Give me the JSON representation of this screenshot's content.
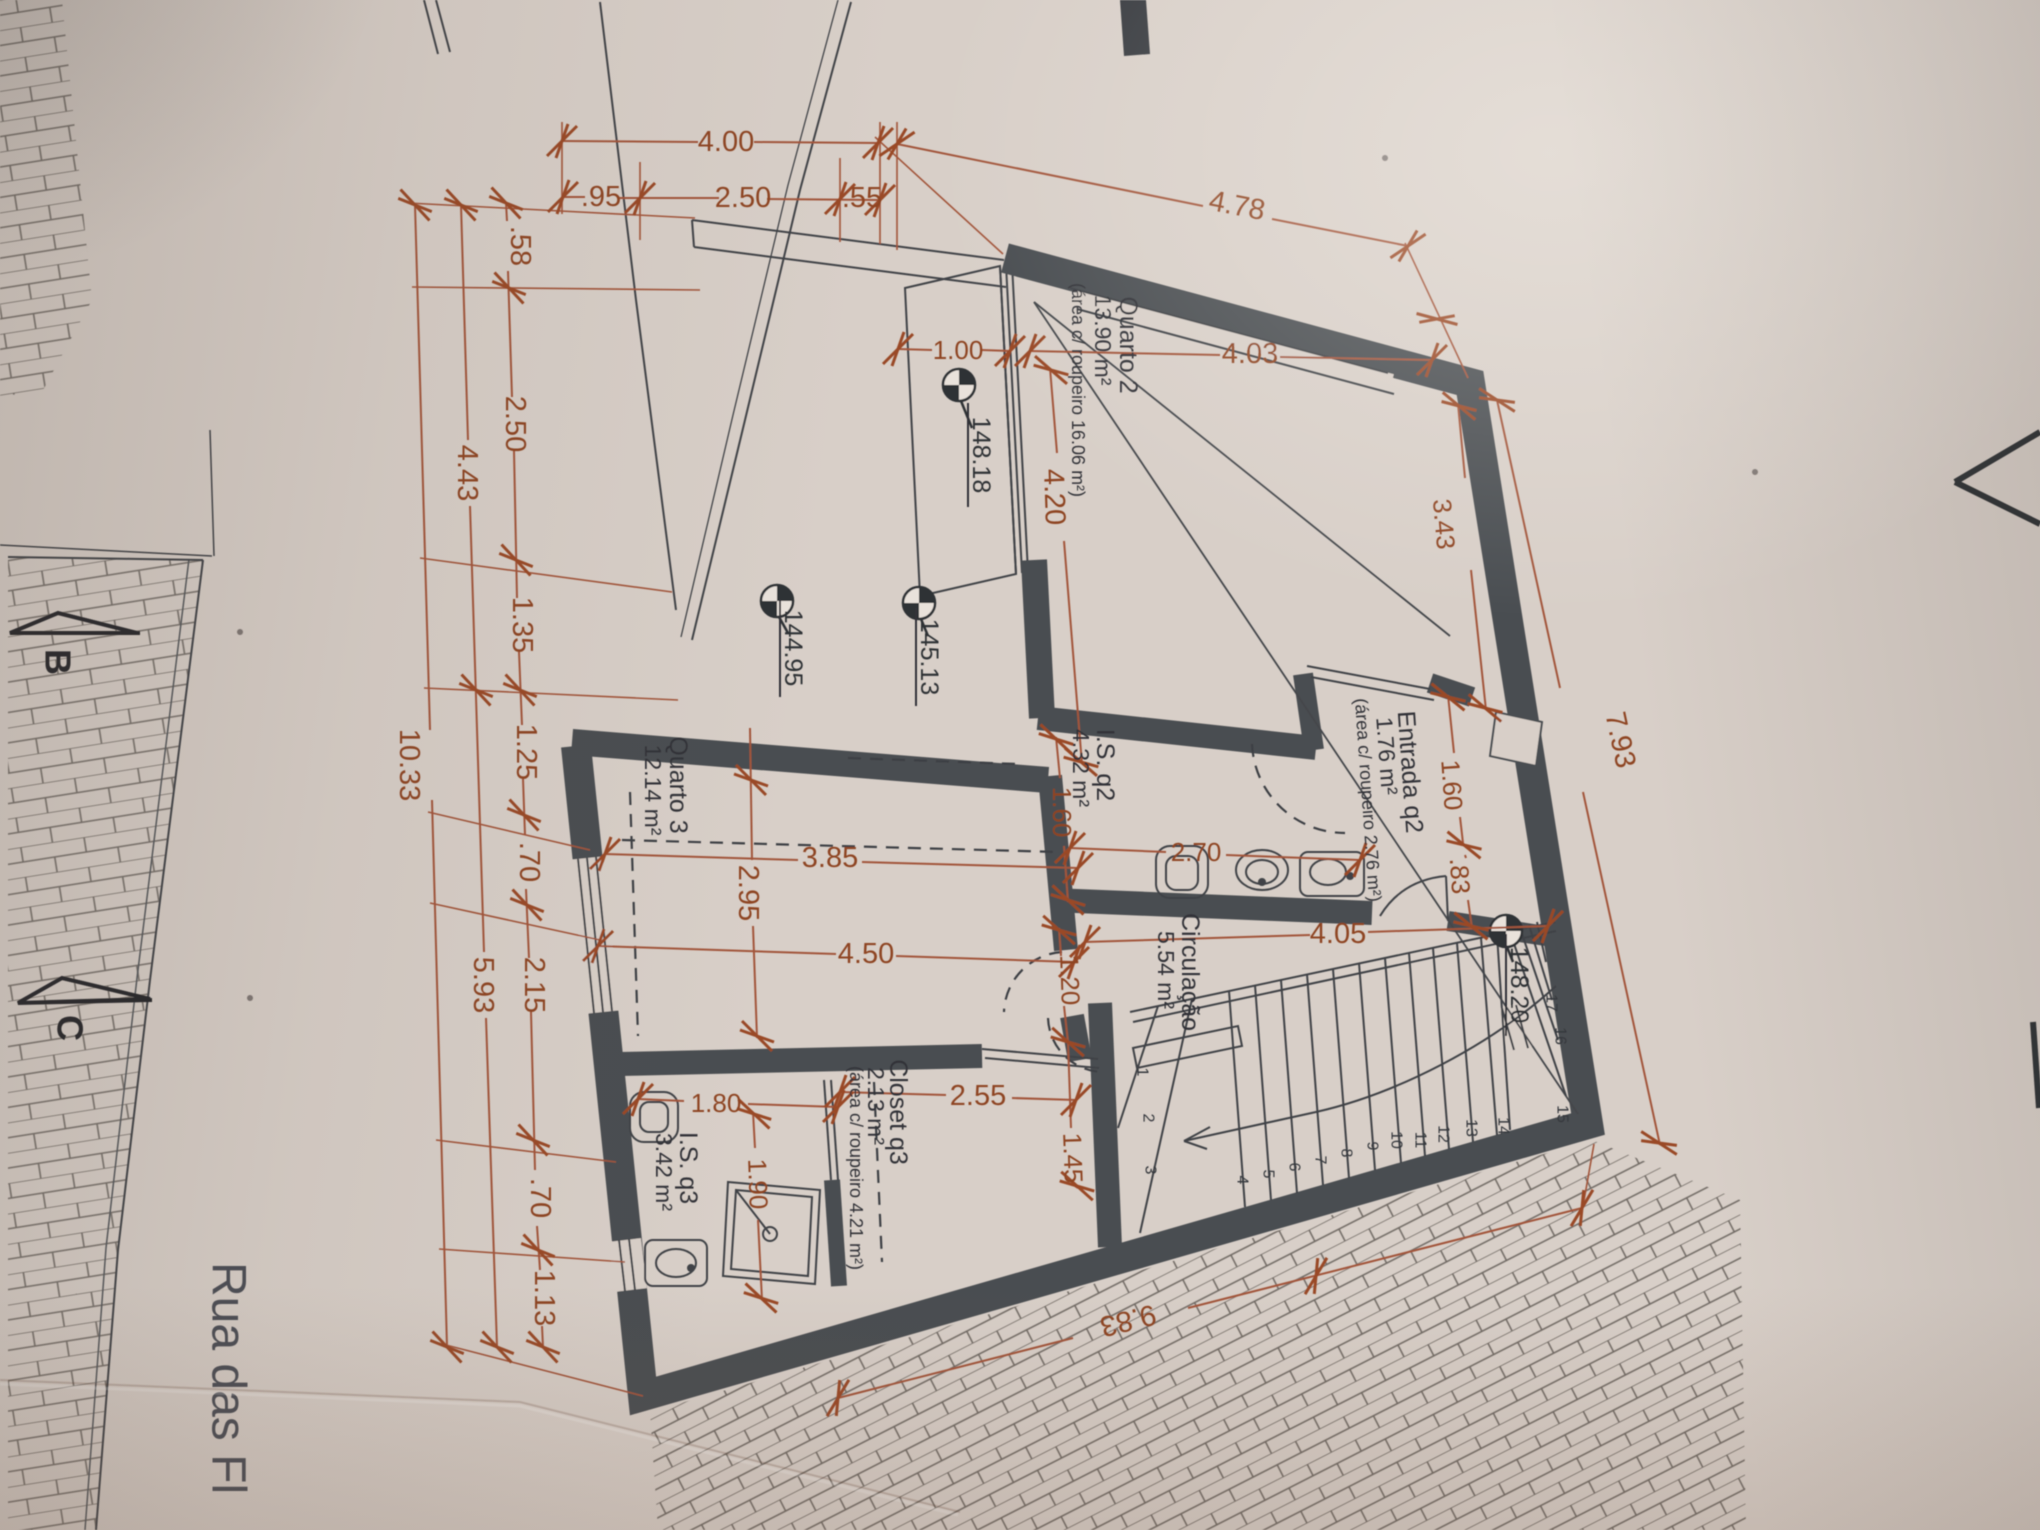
{
  "colors": {
    "paper": "#d8cfc8",
    "wall": "#4a4d51",
    "dim": "#9a4a28"
  },
  "street": {
    "name": "Rua das Fl"
  },
  "sections": {
    "b": "B",
    "c": "C"
  },
  "levels": {
    "l1": "148.18",
    "l2": "144.95",
    "l3": "145.13",
    "l4": "148.20"
  },
  "rooms": {
    "quarto2": {
      "name": "Quarto 2",
      "area": "13.90 m²",
      "note": "(área c/ roupeiro 16.06 m²)"
    },
    "entrada": {
      "name": "Entrada q2",
      "area": "1.76 m²",
      "note": "(área c/ roupeiro 2.76 m²)"
    },
    "isq2": {
      "name": "I.S. q2",
      "area": "4.32 m²"
    },
    "quarto3": {
      "name": "Quarto 3",
      "area": "12.14 m²"
    },
    "circulacao": {
      "name": "Circulação",
      "area": "5.54 m²"
    },
    "closet": {
      "name": "Closet q3",
      "area": "2.13 m²",
      "note": "(área c/ roupeiro 4.21 m²)"
    },
    "isq3": {
      "name": "I.S. q3",
      "area": "3.42 m²"
    }
  },
  "dims": {
    "top": {
      "d400": "4.00",
      "d095": ".95",
      "d250": "2.50",
      "d055": ".55",
      "d478": "4.78"
    },
    "left": {
      "d058": ".58",
      "d250": "2.50",
      "d135": "1.35",
      "d125": "1.25",
      "d070a": ".70",
      "d215": "2.15",
      "d070b": ".70",
      "d113": "1.13",
      "d443": "4.43",
      "d593": "5.93",
      "d1033": "10.33"
    },
    "inner": {
      "d100": "1.00",
      "d403": "4.03",
      "d420": "4.20",
      "d343": "3.43",
      "d793": "7.93",
      "d160a": "1.60",
      "d270": "2.70",
      "d160b": "1.60",
      "d083": ".83",
      "d385": "3.85",
      "d295": "2.95",
      "d450": "4.50",
      "d120": "1.20",
      "d145": "1.45",
      "d405": "4.05",
      "d255": "2.55",
      "d180": "1.80",
      "d190": "1.90",
      "d983": "9.83"
    }
  },
  "stairs": {
    "n1": "1",
    "n2": "2",
    "n3": "3",
    "n4": "4",
    "n5": "5",
    "n6": "6",
    "n7": "7",
    "n8": "8",
    "n9": "9",
    "n10": "10",
    "n11": "11",
    "n12": "12",
    "n13": "13",
    "n14": "14",
    "n15": "15",
    "n16": "16",
    "n17": "17"
  }
}
